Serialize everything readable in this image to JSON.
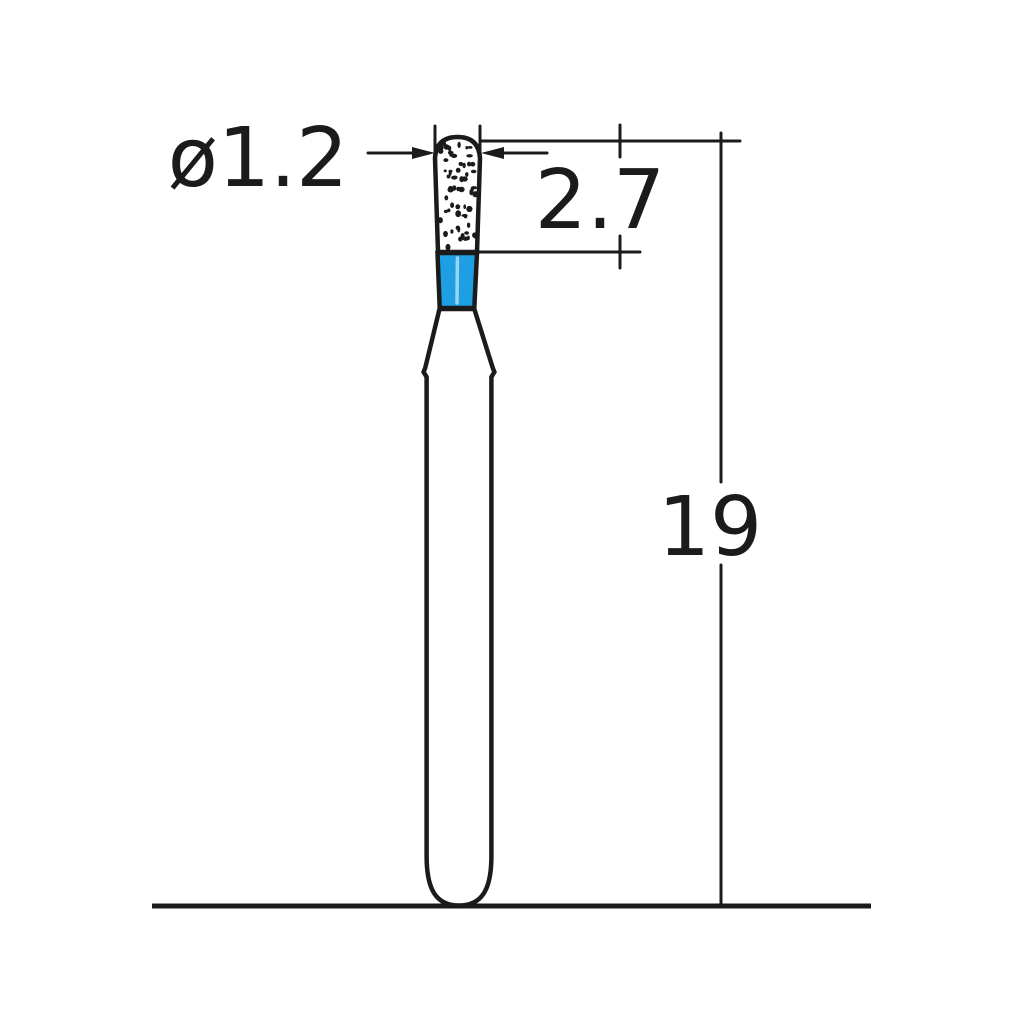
{
  "diagram": {
    "subject": "dental-bur-technical-drawing",
    "dimensions": {
      "head_diameter": {
        "label": "ø1.2"
      },
      "head_length": {
        "label": "2.7"
      },
      "total_length": {
        "label": "19"
      }
    },
    "colors": {
      "outline": "#1b1b1b",
      "neck_blue": "#1e9fe4",
      "neck_highlight": "#9bd4f2",
      "background": "#ffffff"
    }
  }
}
